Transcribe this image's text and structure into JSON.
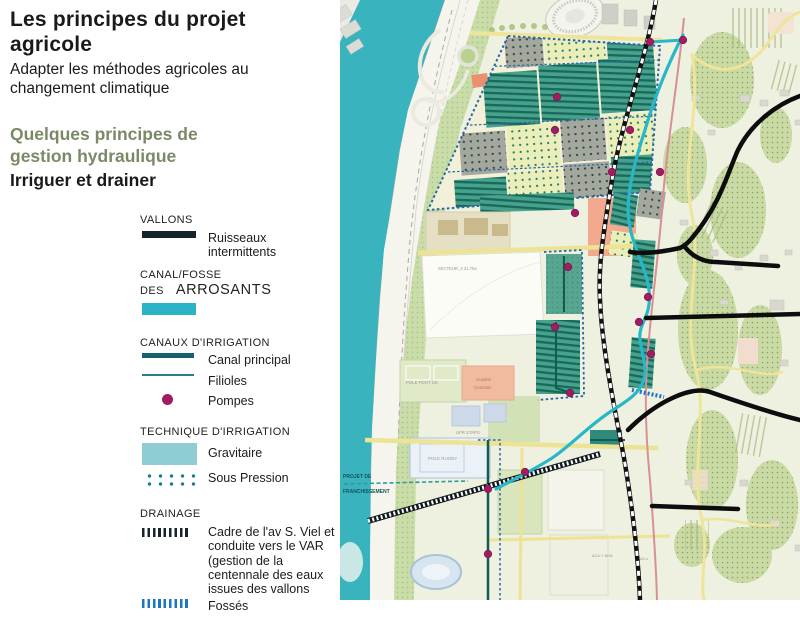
{
  "header": {
    "title": "Les principes du projet agricole",
    "subtitle": "Adapter les méthodes agricoles au changement climatique",
    "section_heading": "Quelques principes de gestion hydraulique",
    "section_subheading": "Irriguer et drainer"
  },
  "legend": {
    "vallons": {
      "heading": "VALLONS",
      "item": "Ruisseaux intermittents"
    },
    "canal_fosse": {
      "heading": "CANAL/FOSSE DES",
      "heading_large": "ARROSANTS"
    },
    "canaux": {
      "heading": "CANAUX D'IRRIGATION",
      "items": [
        "Canal principal",
        "Filioles",
        "Pompes"
      ]
    },
    "technique": {
      "heading": "TECHNIQUE D'IRRIGATION",
      "items": [
        "Gravitaire",
        "Sous Pression"
      ]
    },
    "drainage": {
      "heading": "DRAINAGE",
      "item_cadre": "Cadre de l'av S. Viel et conduite vers le VAR (gestion de la centennale des eaux issues des vallons",
      "item_fosses": "Fossés"
    }
  },
  "map": {
    "labels": {
      "secteur": "SECTEUR_3  21.7ha",
      "pole_foot": "POLE FOOT US",
      "cuisine_line1": "Cuisine",
      "cuisine_line2": "Centrale",
      "ufr": "UFR STAPS",
      "rugby": "POLE RUGBY",
      "projet_line1": "PROJET DE",
      "projet_line2": "FRANCHISSEMENT",
      "parcel_a2b": "A2-b 7.8HA",
      "parcel_a2c": "A2-c"
    },
    "pumps": [
      [
        217,
        97
      ],
      [
        215,
        130
      ],
      [
        290,
        130
      ],
      [
        272,
        172
      ],
      [
        320,
        172
      ],
      [
        310,
        42
      ],
      [
        343,
        40
      ],
      [
        235,
        213
      ],
      [
        228,
        267
      ],
      [
        215,
        327
      ],
      [
        230,
        393
      ],
      [
        308,
        297
      ],
      [
        299,
        322
      ],
      [
        311,
        354
      ],
      [
        185,
        472
      ],
      [
        148,
        489
      ],
      [
        148,
        554
      ]
    ]
  },
  "colors": {
    "section_heading": "#7b8a66",
    "river": "#39b3bd",
    "canal_arrosants": "#29b5c5",
    "canal_principal": "#15616e",
    "pompes": "#a01d62",
    "gravitaire": "#8fccd3",
    "sous_pression": "#1a7e8a",
    "drainage_cadre": "#16242b",
    "drainage_fosses": "#1d76c2",
    "vallons": "#0d0d0d",
    "parcel_stripe": "#47a18c",
    "parcel_yellow_dots": "#ebeeb8",
    "parcel_gray_dots": "#a4a79e",
    "salmon_parcel": "#f2a98e"
  }
}
